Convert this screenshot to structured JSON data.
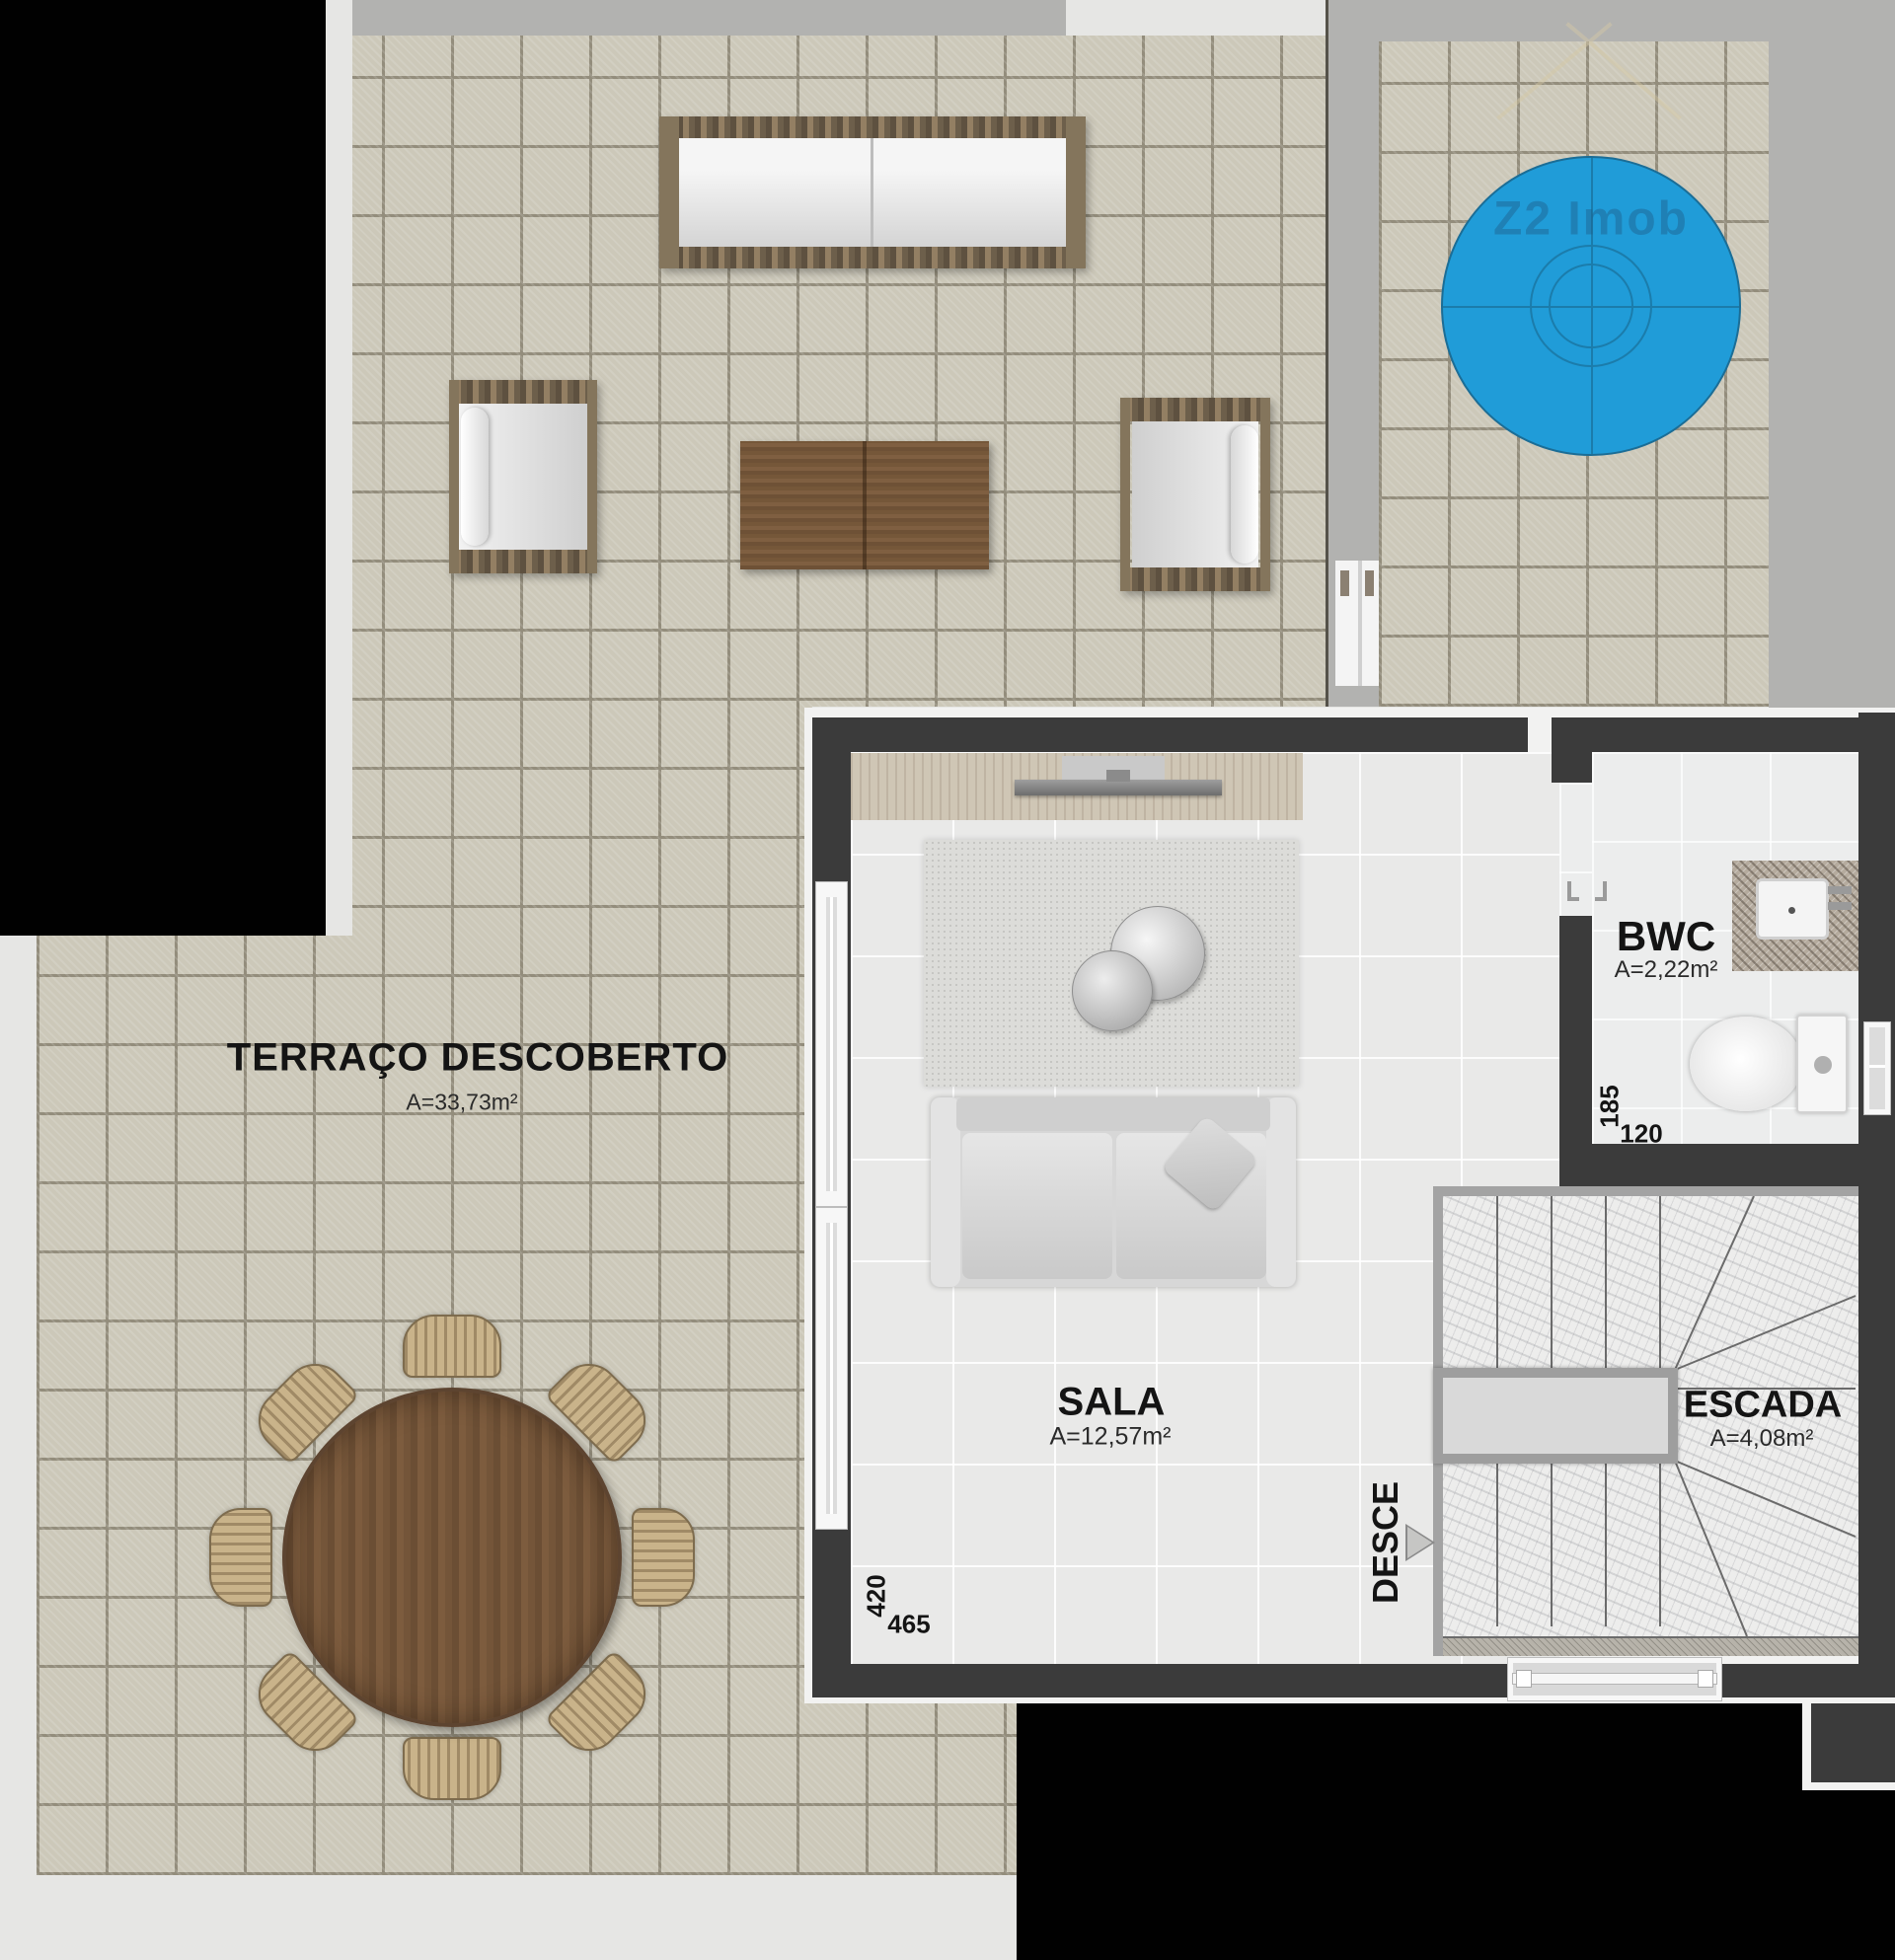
{
  "watermark": {
    "brand": "Z2 Imob"
  },
  "rooms": {
    "terrace": {
      "name": "TERRAÇO DESCOBERTO",
      "area": "A=33,73m²"
    },
    "sala": {
      "name": "SALA",
      "area": "A=12,57m²"
    },
    "bwc": {
      "name": "BWC",
      "area": "A=2,22m²"
    },
    "escada": {
      "name": "ESCADA",
      "area": "A=4,08m²"
    }
  },
  "annotations": {
    "direction": "DESCE"
  },
  "dimensions": {
    "sala_width": "465",
    "sala_depth": "420",
    "bwc_width": "120",
    "bwc_depth": "185"
  },
  "colors": {
    "pool_blue": "#209cd8",
    "wall_dark": "#3b3b3b",
    "wall_light": "#b2b2b0",
    "void_black": "#010101",
    "watermark_blue": "#1e5a86"
  }
}
